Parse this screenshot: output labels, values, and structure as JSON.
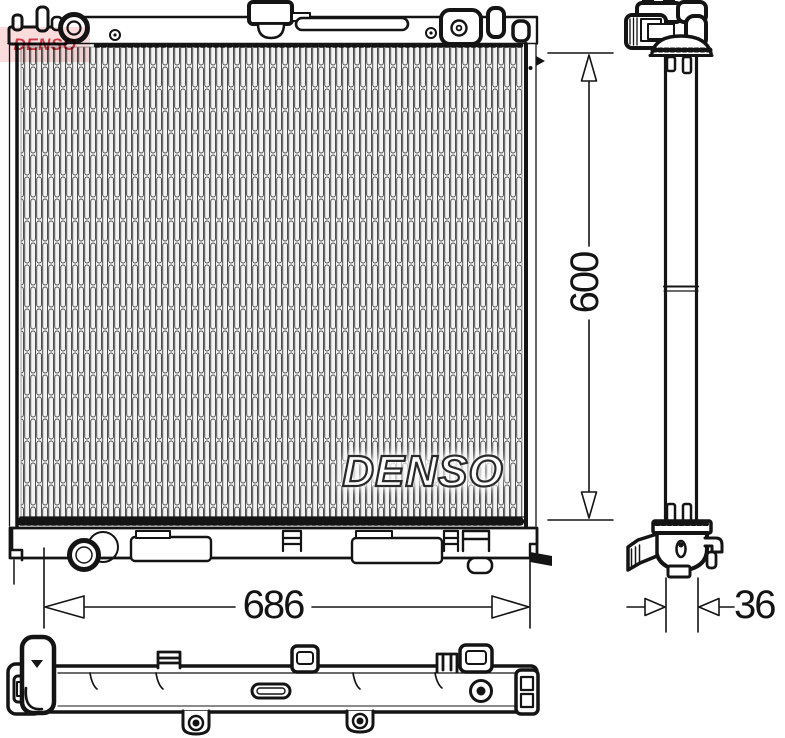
{
  "watermarks": {
    "brand_center": "DENSO",
    "brand_logo": "DENSO"
  },
  "dimensions": {
    "height": "600",
    "width": "686",
    "depth": "36"
  },
  "colors": {
    "background": "#ffffff",
    "line": "#141414",
    "fin_line": "#4d4d4d",
    "core_fill": "#f3f3f3",
    "logo_red": "#c5202e",
    "logo_pink": "#f7caca"
  }
}
